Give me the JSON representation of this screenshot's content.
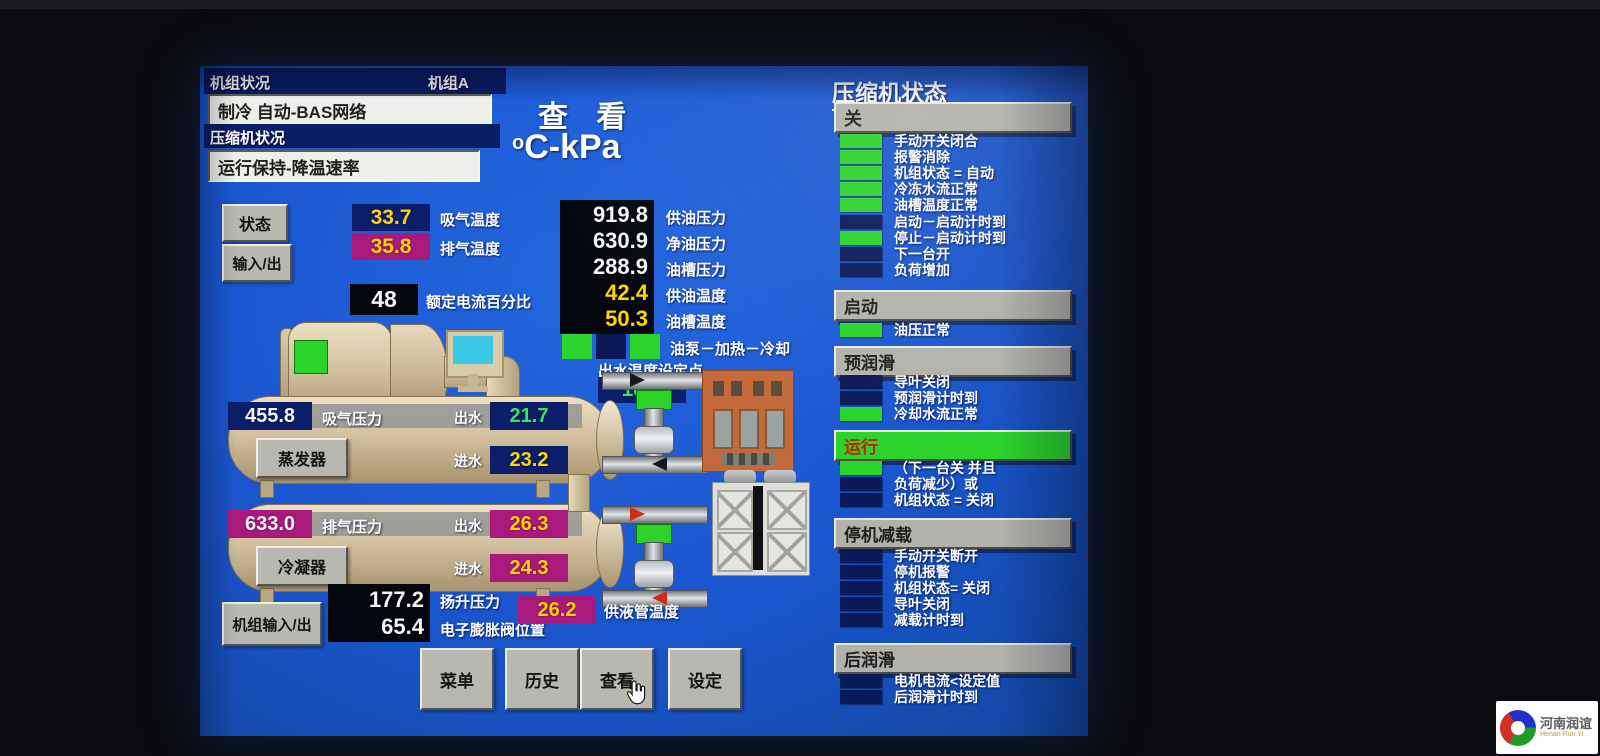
{
  "header": {
    "unit_status_label": "机组状况",
    "unit_name": "机组A",
    "unit_mode": "制冷  自动-BAS网络",
    "compressor_status_label": "压缩机状况",
    "compressor_mode": "运行保持-降温速率",
    "view_title": "查 看",
    "units_sup": "o",
    "units_main": "C-kPa"
  },
  "left_buttons": {
    "status": "状态",
    "io": "输入/出",
    "unit_io": "机组输入/出"
  },
  "readings": {
    "suction_temp": {
      "value": "33.7",
      "label": "吸气温度"
    },
    "discharge_temp": {
      "value": "35.8",
      "label": "排气温度"
    },
    "fla_percent": {
      "value": "48",
      "label": "额定电流百分比"
    },
    "oil_supply_pressure": {
      "value": "919.8",
      "label": "供油压力"
    },
    "oil_net_pressure": {
      "value": "630.9",
      "label": "净油压力"
    },
    "oil_sump_pressure": {
      "value": "288.9",
      "label": "油槽压力"
    },
    "oil_supply_temp": {
      "value": "42.4",
      "label": "供油温度"
    },
    "oil_sump_temp": {
      "value": "50.3",
      "label": "油槽温度"
    },
    "lift_pressure": {
      "value": "177.2",
      "label": "扬升压力"
    },
    "eev_position": {
      "value": "65.4",
      "label": "电子膨胀阀位置"
    },
    "liquid_line_temp": {
      "value": "26.2",
      "label": "供液管温度"
    }
  },
  "oil_pump_indicators": {
    "label": "油泵－加热－冷却",
    "states": [
      "on",
      "off",
      "on"
    ]
  },
  "setpoint": {
    "label": "出水温度设定点",
    "value": "18.0"
  },
  "evaporator": {
    "button": "蒸发器",
    "pressure": "455.8",
    "pressure_label": "吸气压力",
    "leaving_label": "出水",
    "leaving": "21.7",
    "entering_label": "进水",
    "entering": "23.2"
  },
  "condenser": {
    "button": "冷凝器",
    "pressure": "633.0",
    "pressure_label": "排气压力",
    "leaving_label": "出水",
    "leaving": "26.3",
    "entering_label": "进水",
    "entering": "24.3"
  },
  "bottom_buttons": {
    "menu": "菜单",
    "history": "历史",
    "view": "查看",
    "setting": "设定"
  },
  "right_panel": {
    "title": "压缩机状态",
    "state_value": "关",
    "top_items": [
      {
        "label": "手动开关闭合",
        "state": "on"
      },
      {
        "label": "报警消除",
        "state": "on"
      },
      {
        "label": "机组状态 = 自动",
        "state": "on"
      },
      {
        "label": "冷冻水流正常",
        "state": "on"
      },
      {
        "label": "油槽温度正常",
        "state": "on"
      },
      {
        "label": "启动－启动计时到",
        "state": "off"
      },
      {
        "label": "停止－启动计时到",
        "state": "on"
      },
      {
        "label": "下一台开",
        "state": "off"
      },
      {
        "label": "负荷增加",
        "state": "off"
      }
    ],
    "sections": [
      {
        "header": "启动",
        "state": "normal",
        "items": [
          {
            "label": "油压正常",
            "state": "on"
          }
        ]
      },
      {
        "header": "预润滑",
        "state": "normal",
        "items": [
          {
            "label": "导叶关闭",
            "state": "off"
          },
          {
            "label": "预润滑计时到",
            "state": "off"
          },
          {
            "label": "冷却水流正常",
            "state": "on"
          }
        ]
      },
      {
        "header": "运行",
        "state": "active",
        "items": [
          {
            "label": "（下一台关 并且",
            "state": "on"
          },
          {
            "label": "负荷减少）或",
            "state": "off"
          },
          {
            "label": "机组状态 = 关闭",
            "state": "off"
          }
        ]
      },
      {
        "header": "停机减载",
        "state": "normal",
        "items": [
          {
            "label": "手动开关断开",
            "state": "off"
          },
          {
            "label": "停机报警",
            "state": "off"
          },
          {
            "label": "机组状态= 关闭",
            "state": "off"
          },
          {
            "label": "导叶关闭",
            "state": "off"
          },
          {
            "label": "减载计时到",
            "state": "off"
          }
        ]
      },
      {
        "header": "后润滑",
        "state": "normal",
        "items": [
          {
            "label": "电机电流<设定值",
            "state": "off"
          },
          {
            "label": "后润滑计时到",
            "state": "off"
          }
        ]
      }
    ]
  },
  "watermark": {
    "line1": "河南润谊",
    "line2": "Henan Run Yi"
  }
}
